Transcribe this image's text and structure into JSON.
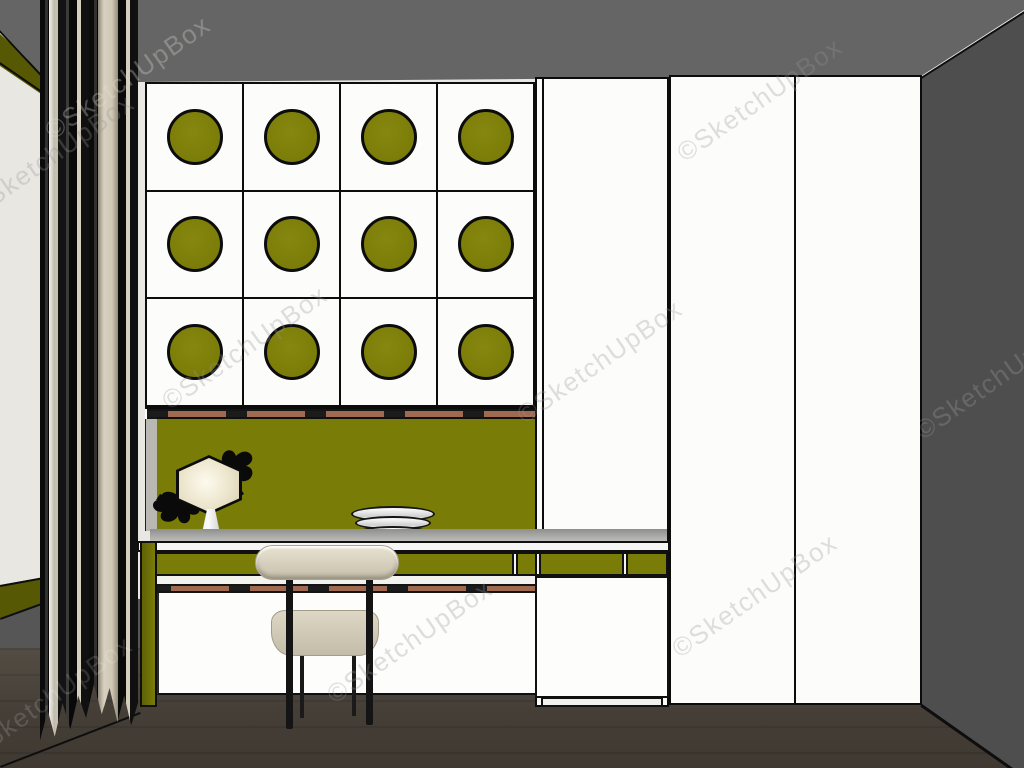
{
  "meta": {
    "type": "3d-interior-rendering",
    "style": "SketchUp model view",
    "description": "Home study room with white built-in desk unit, upper cabinet doors decorated with olive-green circles, olive backsplash, table lamp, stacked plates, beige chair, white wardrobe and dark gray walls with sheer curtain"
  },
  "watermark": {
    "text": "©SketchUpBox"
  },
  "cabinet": {
    "rows": 3,
    "cols": 4,
    "door_count": 12,
    "circle_per_door": 1
  },
  "wardrobe": {
    "door_count": 3
  },
  "desk": {
    "drawer_band": "olive",
    "lamp": "hexagonal table lamp",
    "plates_in_stack": 3
  },
  "chair": {
    "legs": "black metal",
    "upholstery": "beige"
  },
  "colors": {
    "olive": "#7a7c08",
    "olive_dark": "#565804",
    "door_white": "#fcfcfb",
    "wall_white": "#e8e7e1",
    "ceiling_gray": "#656565",
    "wall_dark": "#4e4e4e",
    "floor_brown": "#544d44",
    "trim_clay": "#a06a50",
    "curtain_beige": "#d5cfc0",
    "cushion_beige": "#d2cbb9",
    "edge": "#0c0c0c"
  }
}
